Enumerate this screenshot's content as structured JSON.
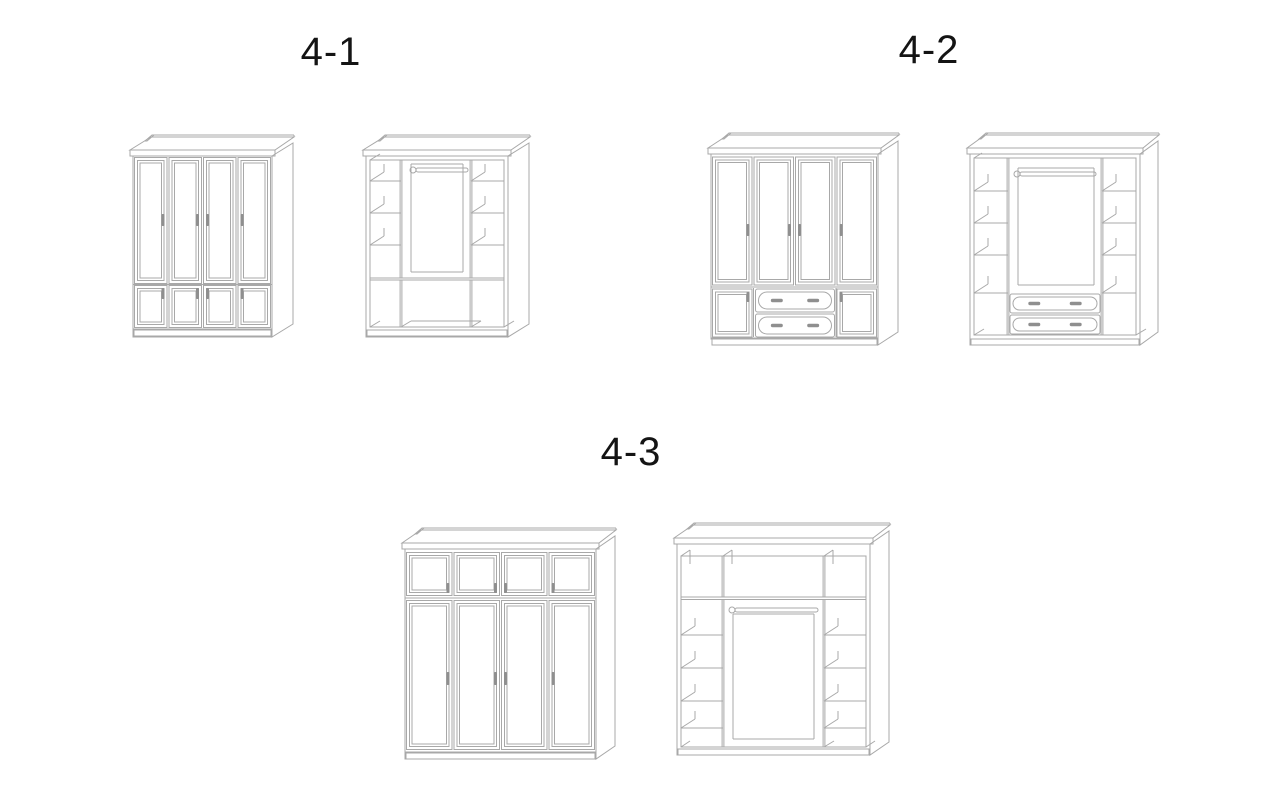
{
  "page": {
    "background": "#ffffff",
    "line_color": "#a8a8a8",
    "handle_color": "#8f8f8f",
    "text_color": "#141414"
  },
  "groups": [
    {
      "label": "4-1",
      "figures": [
        {
          "id": "w41c",
          "view": "closed",
          "tall_doors": 4,
          "short_doors": 4,
          "short_position": "bottom"
        },
        {
          "id": "w41o",
          "view": "open",
          "shelf_levels": 3,
          "hanging_rod": true,
          "base_cells": 3
        }
      ]
    },
    {
      "label": "4-2",
      "figures": [
        {
          "id": "w42c",
          "view": "closed",
          "tall_doors": 4,
          "short_doors": 2,
          "drawers": 2
        },
        {
          "id": "w42o",
          "view": "open",
          "shelf_levels": 4,
          "hanging_rod": true,
          "drawers": 2
        }
      ]
    },
    {
      "label": "4-3",
      "figures": [
        {
          "id": "w43c",
          "view": "closed",
          "tall_doors": 4,
          "short_doors": 4,
          "short_position": "top"
        },
        {
          "id": "w43o",
          "view": "open",
          "shelf_levels": 4,
          "hanging_rod": true,
          "top_cells": 3
        }
      ]
    }
  ]
}
